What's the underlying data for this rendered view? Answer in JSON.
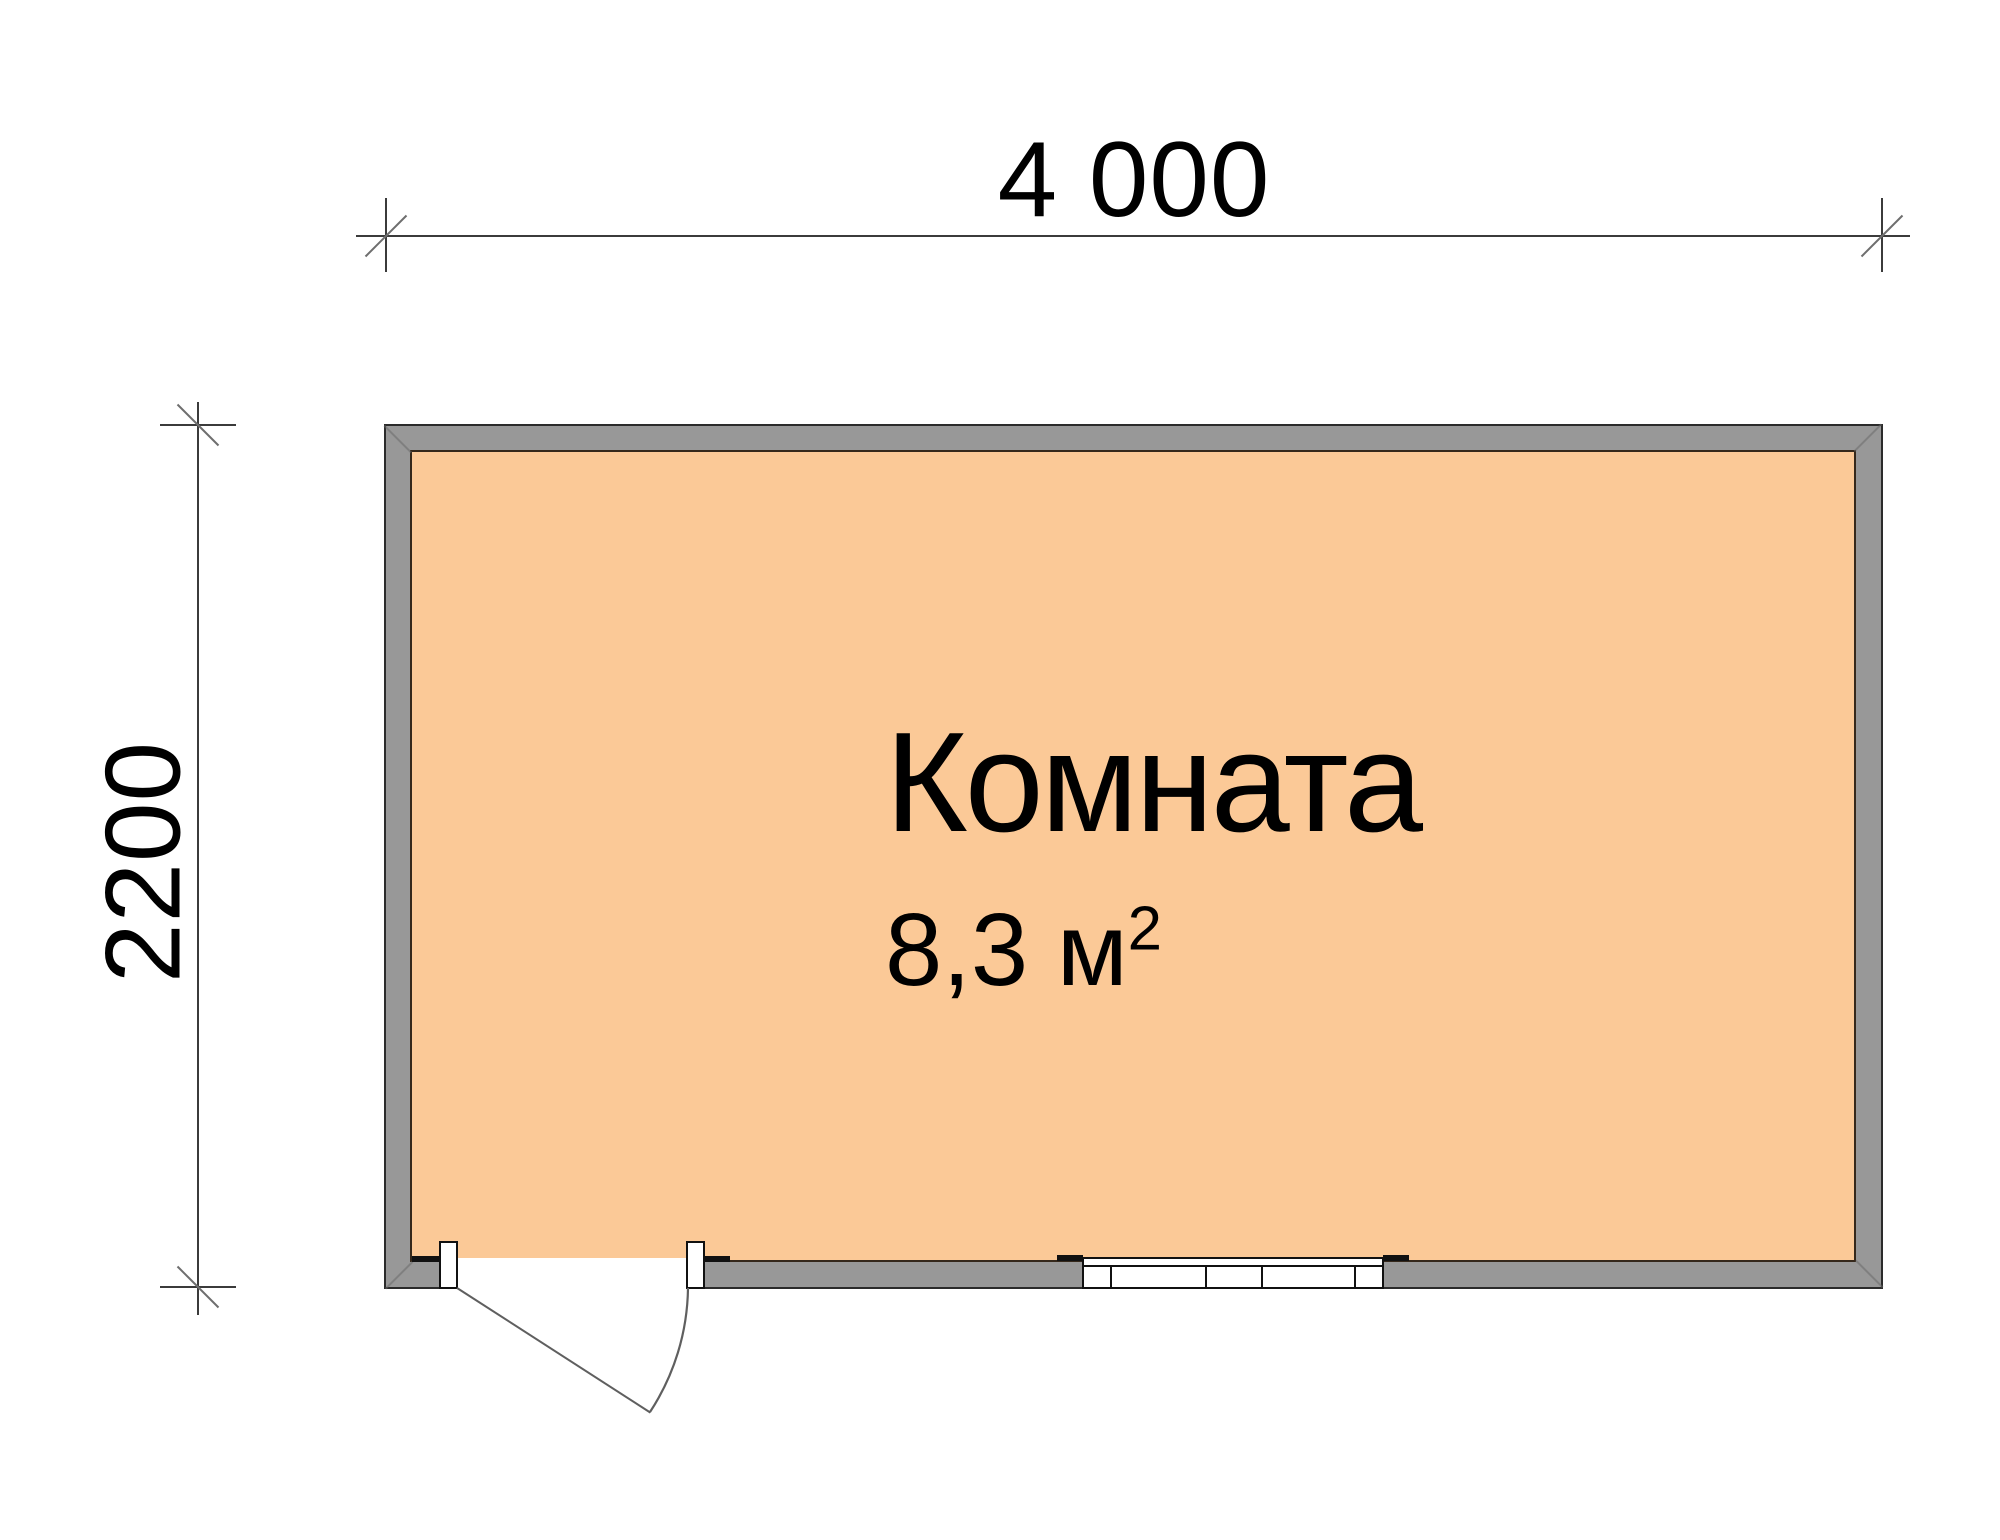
{
  "drawing": {
    "type": "floor-plan",
    "room": {
      "name": "Комната",
      "area_value": "8,3",
      "area_unit": "м",
      "area_exponent": "2"
    },
    "dimensions": {
      "width_mm": "4 000",
      "height_mm": "2200"
    },
    "features": {
      "door": "swing door, bottom-left, opens outward",
      "window": "bottom wall, right of door"
    },
    "colors": {
      "background": "#FFFFFF",
      "floor": "#FBC997",
      "wall": "#989898",
      "wall_outline": "#2B2B2B",
      "floor_outline": "#35281B",
      "dim_line": "#3B3B3B",
      "tick": "#6E6E6E",
      "door_line": "#5F5F5F",
      "text": "#000000"
    }
  }
}
